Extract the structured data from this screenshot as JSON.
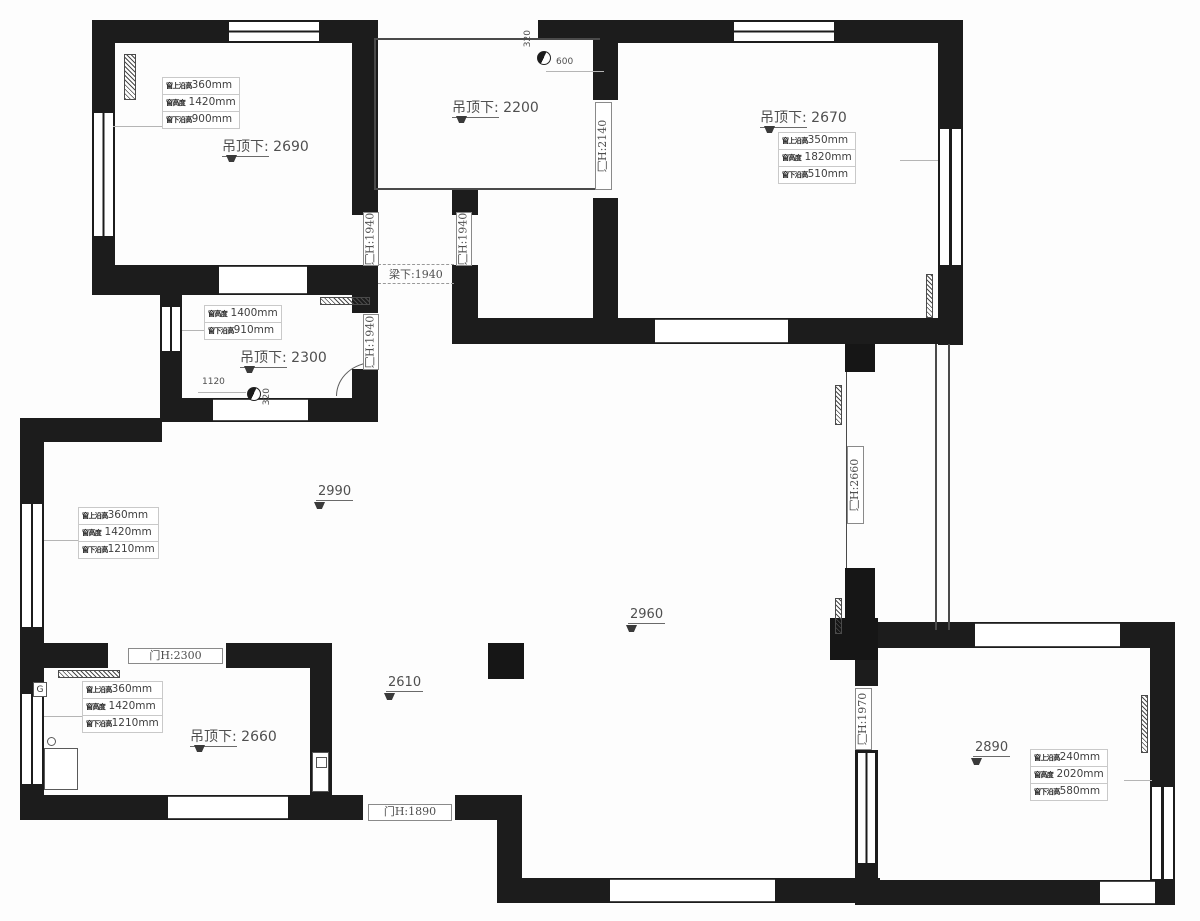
{
  "colors": {
    "wall": "#1c1c1c",
    "thin_line": "#4a4a4a",
    "text": "#4f4f4f",
    "annotation_border": "#c9c9c9",
    "background": "#fdfdfd"
  },
  "ceilings": {
    "top_left": {
      "label": "吊顶下:",
      "value": "2690"
    },
    "top_middle": {
      "label": "吊顶下:",
      "value": "2200"
    },
    "top_right": {
      "label": "吊顶下:",
      "value": "2670"
    },
    "bath": {
      "label": "吊顶下:",
      "value": "2300"
    },
    "kitchen": {
      "label": "吊顶下:",
      "value": "2660"
    }
  },
  "markers": {
    "living_a": "2990",
    "living_b": "2960",
    "living_c": "2610",
    "bedroom_br": "2890"
  },
  "annotations": {
    "top_left": {
      "rows": [
        {
          "k": "窗上沿高",
          "v": "360mm"
        },
        {
          "k": "窗高度",
          "v": "1420mm"
        },
        {
          "k": "窗下沿高",
          "v": "900mm"
        }
      ]
    },
    "top_right": {
      "rows": [
        {
          "k": "窗上沿高",
          "v": "350mm"
        },
        {
          "k": "窗高度",
          "v": "1820mm"
        },
        {
          "k": "窗下沿高",
          "v": "510mm"
        }
      ]
    },
    "bath": {
      "rows": [
        {
          "k": "窗高度",
          "v": "1400mm"
        },
        {
          "k": "窗下沿高",
          "v": "910mm"
        }
      ]
    },
    "living": {
      "rows": [
        {
          "k": "窗上沿高",
          "v": "360mm"
        },
        {
          "k": "窗高度",
          "v": "1420mm"
        },
        {
          "k": "窗下沿高",
          "v": "1210mm"
        }
      ]
    },
    "kitchen": {
      "rows": [
        {
          "k": "窗上沿高",
          "v": "360mm"
        },
        {
          "k": "窗高度",
          "v": "1420mm"
        },
        {
          "k": "窗下沿高",
          "v": "1210mm"
        }
      ]
    },
    "bedroom_br": {
      "rows": [
        {
          "k": "窗上沿高",
          "v": "240mm"
        },
        {
          "k": "窗高度",
          "v": "2020mm"
        },
        {
          "k": "窗下沿高",
          "v": "580mm"
        }
      ]
    }
  },
  "doors": {
    "d2140": "门H:2140",
    "d1940_a": "门H:1940",
    "d1940_b": "门H:1940",
    "d1940_c": "门H:1940",
    "d2300": "门H:2300",
    "d1890": "门H:1890",
    "d2660": "门H:2660",
    "d1970": "门H:1970"
  },
  "beam": {
    "label": "梁下:1940"
  },
  "dims": {
    "tm_320": "320",
    "tm_600": "600",
    "bath_1120": "1120",
    "bath_320": "320"
  },
  "badges": {
    "gas": "G"
  }
}
